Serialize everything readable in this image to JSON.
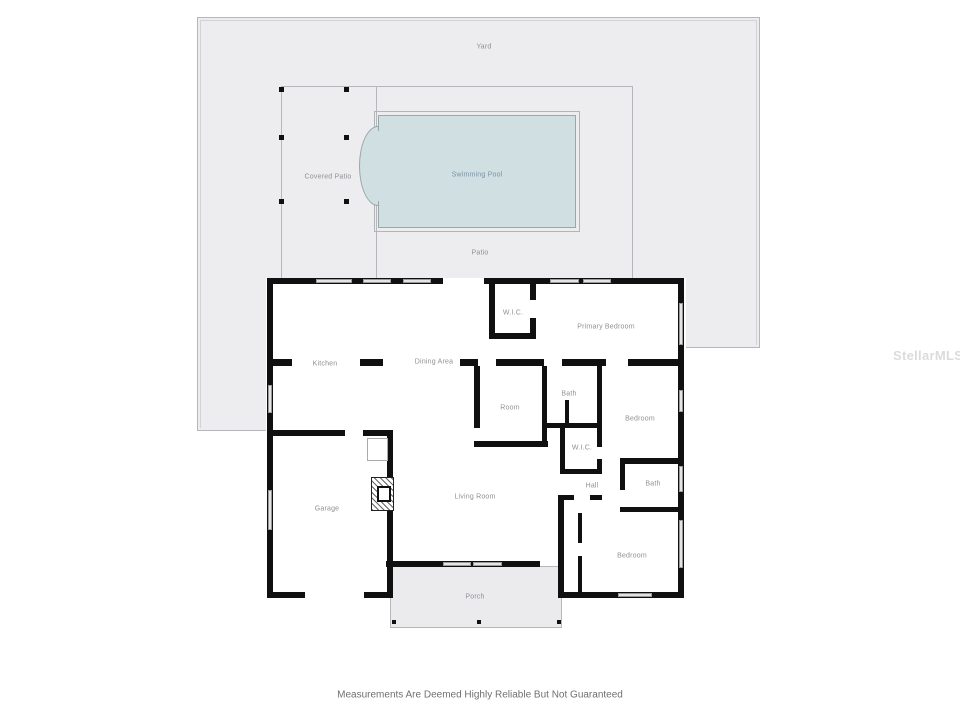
{
  "plan": {
    "watermark": "StellarMLS",
    "disclaimer": "Measurements Are Deemed Highly Reliable But Not Guaranteed",
    "outdoor": {
      "yard": "Yard",
      "covered_patio": "Covered Patio",
      "swimming_pool": "Swimming Pool",
      "patio": "Patio",
      "porch": "Porch"
    },
    "rooms": {
      "wic_primary": "W.I.C.",
      "primary_bedroom": "Primary Bedroom",
      "kitchen": "Kitchen",
      "dining_area": "Dining Area",
      "room": "Room",
      "bath_1": "Bath",
      "bedroom_1": "Bedroom",
      "wic_hall": "W.I.C.",
      "hall": "Hall",
      "bath_2": "Bath",
      "bedroom_2": "Bedroom",
      "garage": "Garage",
      "living_room": "Living Room"
    },
    "colors": {
      "pool_water": "#cfdfe2",
      "ground": "#ededef",
      "wall": "#101010"
    }
  }
}
